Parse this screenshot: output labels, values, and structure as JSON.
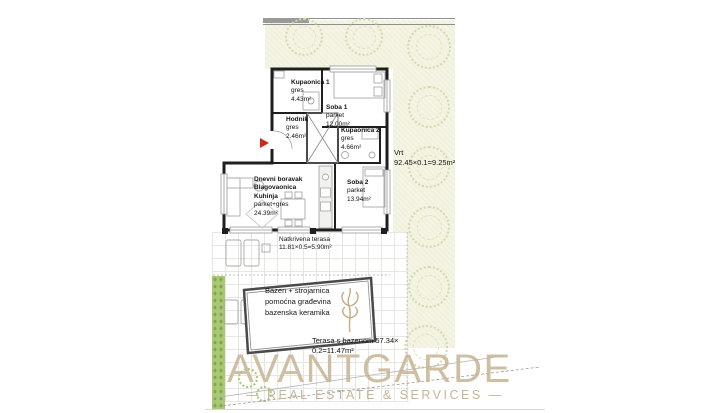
{
  "colors": {
    "garden": "#f5f3e2",
    "tree_outline": "#d3dba9",
    "hedge_green": "#a9c873",
    "wall": "#1f1f1f",
    "logo_tan": "#c6b494",
    "entrance_arrow_red": "#cc2b1c"
  },
  "rooms": {
    "kupaonica1": {
      "name": "Kupaonica 1",
      "floor": "gres",
      "area": "4.43m²"
    },
    "soba1": {
      "name": "Soba 1",
      "floor": "parket",
      "area": "12.00m²"
    },
    "hodnik": {
      "name": "Hodnik",
      "floor": "gres",
      "area": "2.46m²"
    },
    "kupaonica2": {
      "name": "Kupaonica 2",
      "floor": "gres",
      "area": "4.66m²"
    },
    "dnevni": {
      "name1": "Dnevni boravak",
      "name2": "Blagovaonica",
      "name3": "Kuhinja",
      "floor": "parket+gres",
      "area": "24.39m²"
    },
    "soba2": {
      "name": "Soba 2",
      "floor": "parket",
      "area": "13.94m²"
    }
  },
  "outdoor": {
    "vrt": {
      "name": "Vrt",
      "calc": "92.45×0.1=9.25m²"
    },
    "natkrivena_terasa": {
      "name": "Natkrivena terasa",
      "calc": "11.81×0.5=5.90m²"
    },
    "bazen": {
      "line1": "Bazen + strojarnica",
      "line2": "pomoćna građevina",
      "line3": "bazenska keramika"
    },
    "terasa_s_bazenom": {
      "line1": "Terasa s bazenom 57.34×",
      "line2": "0.2=11.47m²"
    }
  },
  "branding": {
    "name": "AVANTGARDE",
    "tagline": "— REAL ESTATE & SERVICES —"
  }
}
